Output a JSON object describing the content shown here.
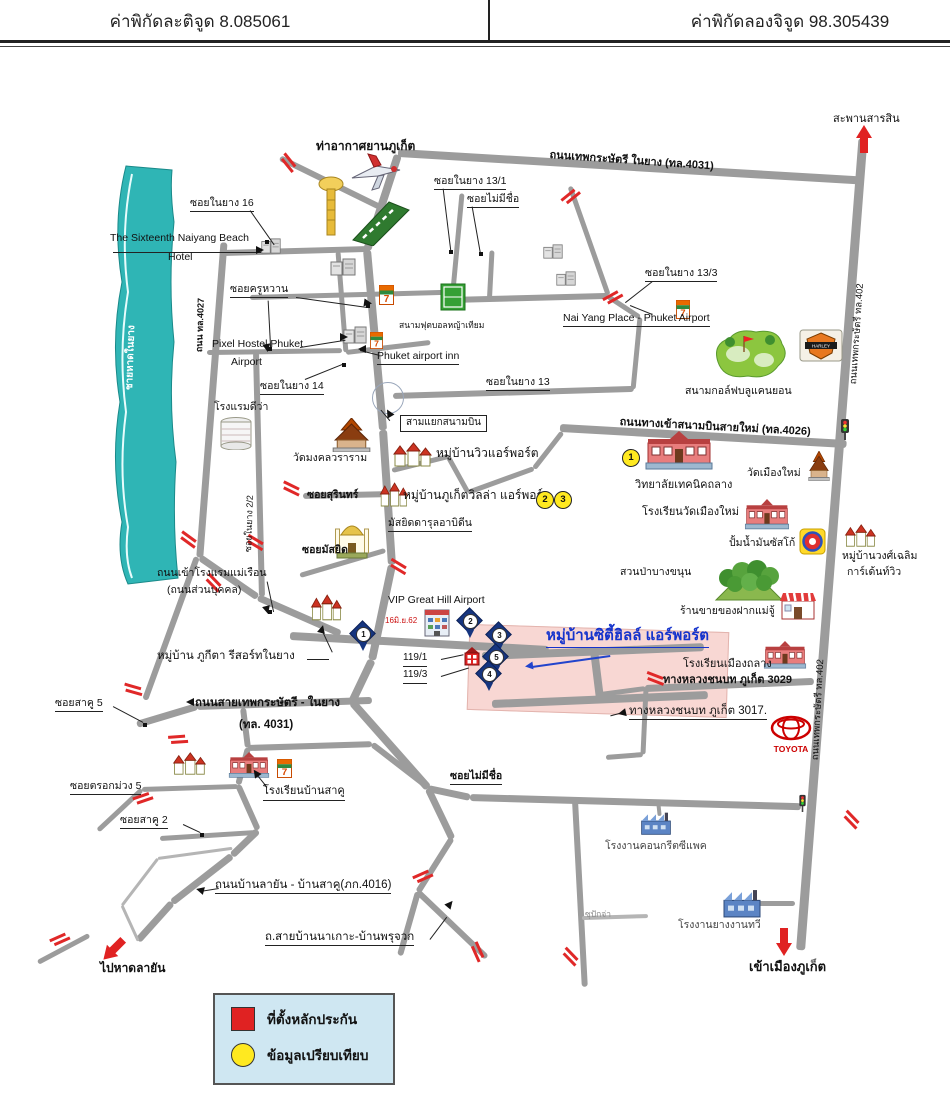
{
  "header": {
    "latitude": "ค่าพิกัดละติจูด 8.085061",
    "longitude": "ค่าพิกัดลองจิจูด 98.305439"
  },
  "destination": {
    "name": "หมู่บ้านซิตี้ฮิลล์ แอร์พอร์ต",
    "house_numbers": [
      "119/1",
      "119/3"
    ],
    "latitude": "8.085061",
    "longitude": "98.305439"
  },
  "legend": {
    "collateral_label": "ที่ตั้งหลักประกัน",
    "comparison_label": "ข้อมูลเปรียบเทียบ",
    "collateral_color": "#e02222",
    "comparison_color": "#ffe920",
    "box_bg": "#cfe7f2"
  },
  "map": {
    "labels": [
      {
        "name": "airport-name",
        "text": "ท่าอากาศยานภูเก็ต",
        "x": 316,
        "y": 139,
        "cls": "b f12"
      },
      {
        "name": "sarasin-bridge",
        "text": "สะพานสารสิน",
        "x": 833,
        "y": 113,
        "cls": "f11"
      },
      {
        "name": "soi-naiyang-16",
        "text": "ซอยในยาง 16",
        "x": 190,
        "y": 197,
        "cls": "u"
      },
      {
        "name": "sixteenth-hotel-1",
        "text": "The Sixteenth Naiyang Beach",
        "x": 110,
        "y": 232,
        "cls": ""
      },
      {
        "name": "sixteenth-hotel-2",
        "text": "Hotel",
        "x": 168,
        "y": 251,
        "cls": ""
      },
      {
        "name": "road-thep-naiyang-4031",
        "text": "ถนนเทพกระษัตรี ในยาง (ทล.4031)",
        "x": 550,
        "y": 149,
        "cls": "b f11",
        "r": 4
      },
      {
        "name": "soi-naiyang-13-1",
        "text": "ซอยในยาง 13/1",
        "x": 434,
        "y": 175,
        "cls": "u"
      },
      {
        "name": "soi-no-name-north",
        "text": "ซอยไม่มีชื่อ",
        "x": 467,
        "y": 193,
        "cls": "u"
      },
      {
        "name": "soi-naiyang-13-3",
        "text": "ซอยในยาง 13/3",
        "x": 645,
        "y": 267,
        "cls": "u"
      },
      {
        "name": "naiyang-place",
        "text": "Nai Yang Place - Phuket Airport",
        "x": 563,
        "y": 312,
        "cls": "u"
      },
      {
        "name": "road-402-upper",
        "text": "ถนนเทพกระษัตรี ทล.402",
        "x": 848,
        "y": 384,
        "cls": "f95",
        "r": -86
      },
      {
        "name": "football-field",
        "text": "สนามฟุตบอลหญ้าเทียม",
        "x": 399,
        "y": 320,
        "cls": "f85"
      },
      {
        "name": "soi-kru-waan",
        "text": "ซอยครูหวาน",
        "x": 230,
        "y": 283,
        "cls": "u"
      },
      {
        "name": "road-4027",
        "text": "ถนน ทล.4027",
        "x": 194,
        "y": 352,
        "cls": "f9 b",
        "r": -88
      },
      {
        "name": "pixel-hostel-1",
        "text": "Pixel Hostel Phuket",
        "x": 212,
        "y": 338,
        "cls": ""
      },
      {
        "name": "pixel-hostel-2",
        "text": "Airport",
        "x": 231,
        "y": 356,
        "cls": ""
      },
      {
        "name": "phuket-airport-inn",
        "text": "Phuket airport inn",
        "x": 377,
        "y": 350,
        "cls": "u"
      },
      {
        "name": "soi-naiyang-14",
        "text": "ซอยในยาง 14",
        "x": 260,
        "y": 380,
        "cls": "u"
      },
      {
        "name": "soi-naiyang-13",
        "text": "ซอยในยาง 13",
        "x": 486,
        "y": 376,
        "cls": "u"
      },
      {
        "name": "airport-junction",
        "text": "สามแยกสนามบิน",
        "x": 400,
        "y": 415,
        "cls": "box f10"
      },
      {
        "name": "dewa-hotel",
        "text": "โรงแรมดีว่า",
        "x": 214,
        "y": 401,
        "cls": ""
      },
      {
        "name": "wat-mongkhol-wararam",
        "text": "วัดมงคลวราราม",
        "x": 293,
        "y": 452,
        "cls": ""
      },
      {
        "name": "soi-naiyang-2-2",
        "text": "ซอยในยาง 2/2",
        "x": 243,
        "y": 552,
        "cls": "f9",
        "r": -88
      },
      {
        "name": "soi-surin",
        "text": "ซอยสุรินทร์",
        "x": 307,
        "y": 489,
        "cls": "b"
      },
      {
        "name": "muban-view-airport",
        "text": "หมู่บ้านวิวแอร์พอร์ต",
        "x": 436,
        "y": 446,
        "cls": "f12"
      },
      {
        "name": "muban-phuket-villa-airport",
        "text": "หมู่บ้านภูเก็ตวิลล่า แอร์พอร์ต",
        "x": 403,
        "y": 488,
        "cls": "f12"
      },
      {
        "name": "masjid-darul-abidin",
        "text": "มัสยิดดารุลอาบิดีน",
        "x": 388,
        "y": 517,
        "cls": "u"
      },
      {
        "name": "soi-masjid",
        "text": "ซอยมัสยิด",
        "x": 302,
        "y": 544,
        "cls": "b"
      },
      {
        "name": "road-4026",
        "text": "ถนนทางเข้าสนามบินสายใหม่ (ทล.4026)",
        "x": 620,
        "y": 416,
        "cls": "b f11",
        "r": 3
      },
      {
        "name": "thalang-technical-college",
        "text": "วิทยาลัยเทคนิคถลาง",
        "x": 635,
        "y": 479,
        "cls": "f11"
      },
      {
        "name": "wat-muang-mai",
        "text": "วัดเมืองใหม่",
        "x": 747,
        "y": 467,
        "cls": ""
      },
      {
        "name": "school-wat-muang-mai",
        "text": "โรงเรียนวัดเมืองใหม่",
        "x": 642,
        "y": 506,
        "cls": "f11"
      },
      {
        "name": "susco-gas-station",
        "text": "ปั้มน้ำมันซัสโก้",
        "x": 729,
        "y": 537,
        "cls": ""
      },
      {
        "name": "muban-wong-chaloem-1",
        "text": "หมู่บ้านวงศ์เฉลิม",
        "x": 842,
        "y": 550,
        "cls": ""
      },
      {
        "name": "muban-wong-chaloem-2",
        "text": "การ์เด้นท์วิว",
        "x": 847,
        "y": 566,
        "cls": ""
      },
      {
        "name": "bang-khanun-forest-park",
        "text": "สวนป่าบางขนุน",
        "x": 620,
        "y": 566,
        "cls": ""
      },
      {
        "name": "mae-ju-souvenir-shop",
        "text": "ร้านขายของฝากแม่จู้",
        "x": 680,
        "y": 605,
        "cls": ""
      },
      {
        "name": "mae-ruen-road-1",
        "text": "ถนนเข้าโรงแรมแม่เรือน",
        "x": 157,
        "y": 567,
        "cls": ""
      },
      {
        "name": "mae-ruen-road-2",
        "text": "(ถนนส่วนบุคคล)",
        "x": 167,
        "y": 584,
        "cls": ""
      },
      {
        "name": "vip-great-hill-airport",
        "text": "VIP Great Hill Airport",
        "x": 388,
        "y": 594,
        "cls": ""
      },
      {
        "name": "red-date-note",
        "text": "16มิ.ย.62",
        "x": 385,
        "y": 616,
        "cls": "red f8"
      },
      {
        "name": "muban-city-hill-airport",
        "text": "หมู่บ้านซิตี้ฮิลล์ แอร์พอร์ต",
        "x": 546,
        "y": 627,
        "cls": "blue b u f15"
      },
      {
        "name": "house-no-119-1",
        "text": "119/1",
        "x": 403,
        "y": 652,
        "cls": "u f10"
      },
      {
        "name": "house-no-119-3",
        "text": "119/3",
        "x": 403,
        "y": 669,
        "cls": "u f10"
      },
      {
        "name": "muban-phukita-resort",
        "text": "หมู่บ้าน ภูกีตา รีสอร์ทในยาง",
        "x": 157,
        "y": 649,
        "cls": "f115"
      },
      {
        "name": "school-muang-thalang",
        "text": "โรงเรียนเมืองถลาง",
        "x": 683,
        "y": 658,
        "cls": "f11"
      },
      {
        "name": "road-3029",
        "text": "ทางหลวงชนบท ภูเก็ต 3029",
        "x": 663,
        "y": 674,
        "cls": "b f11"
      },
      {
        "name": "road-3017",
        "text": "ทางหลวงชนบท ภูเก็ต 3017.",
        "x": 629,
        "y": 704,
        "cls": "u f115"
      },
      {
        "name": "road-402-lower",
        "text": "ถนนเทพกระษัตรี ทล.402",
        "x": 810,
        "y": 760,
        "cls": "f95",
        "r": -87
      },
      {
        "name": "soi-saku-5",
        "text": "ซอยสาคู 5",
        "x": 55,
        "y": 697,
        "cls": "u"
      },
      {
        "name": "road-4031-west-1",
        "text": "ถนนสายเทพกระษัตรี - ในยาง",
        "x": 195,
        "y": 696,
        "cls": "b f115"
      },
      {
        "name": "road-4031-west-2",
        "text": "(ทล. 4031)",
        "x": 239,
        "y": 718,
        "cls": "b f115"
      },
      {
        "name": "soi-trok-muang-5",
        "text": "ซอยตรอกม่วง 5",
        "x": 70,
        "y": 780,
        "cls": "u"
      },
      {
        "name": "soi-saku-2",
        "text": "ซอยสาคู 2",
        "x": 120,
        "y": 814,
        "cls": "u"
      },
      {
        "name": "school-ban-saku",
        "text": "โรงเรียนบ้านสาคู",
        "x": 263,
        "y": 785,
        "cls": "u f11"
      },
      {
        "name": "soi-no-name-south",
        "text": "ซอยไม่มีชื่อ",
        "x": 450,
        "y": 770,
        "cls": "b u"
      },
      {
        "name": "road-ban-layan-saku-4016",
        "text": "ถนนบ้านลายัน - บ้านสาคู(ภก.4016)",
        "x": 215,
        "y": 878,
        "cls": "u f115"
      },
      {
        "name": "road-ban-na-ko",
        "text": "ถ.สายบ้านนาเกาะ-บ้านพรุจวก",
        "x": 265,
        "y": 930,
        "cls": "u f115"
      },
      {
        "name": "to-layan-beach",
        "text": "ไปหาดลายัน",
        "x": 100,
        "y": 961,
        "cls": "b f12"
      },
      {
        "name": "su-pak-ja",
        "text": "ซุปักจ่า",
        "x": 585,
        "y": 909,
        "cls": "gray f85"
      },
      {
        "name": "cpac-concrete-factory",
        "text": "โรงงานคอนกรีตซีแพค",
        "x": 605,
        "y": 840,
        "cls": "dim"
      },
      {
        "name": "ngan-thawee-rubber-factory",
        "text": "โรงงานยางงานทวี",
        "x": 678,
        "y": 919,
        "cls": "dim"
      },
      {
        "name": "to-phuket-town",
        "text": "เข้าเมืองภูเก็ต",
        "x": 749,
        "y": 959,
        "cls": "b f13"
      },
      {
        "name": "blue-canyon-golf",
        "text": "สนามกอล์ฟบลูแคนยอน",
        "x": 685,
        "y": 385,
        "cls": ""
      },
      {
        "name": "naiyang-beach",
        "text": "ชายหาดในยาง",
        "x": 124,
        "y": 390,
        "cls": "white b f10",
        "r": -88
      }
    ],
    "site_pins": [
      {
        "num": "1",
        "x": 363,
        "y": 634
      },
      {
        "num": "2",
        "x": 470,
        "y": 621
      },
      {
        "num": "3",
        "x": 499,
        "y": 635
      },
      {
        "num": "5",
        "x": 496,
        "y": 657
      },
      {
        "num": "4",
        "x": 489,
        "y": 674
      }
    ],
    "comparison_markers": [
      {
        "num": "1",
        "x": 622,
        "y": 449
      },
      {
        "num": "2",
        "x": 536,
        "y": 491
      },
      {
        "num": "3",
        "x": 554,
        "y": 491
      }
    ],
    "colors": {
      "road": "#9c9c9c",
      "beach": "#2fb5b5",
      "destination_text": "#1533cc",
      "collateral_marker": "#e02222",
      "comparison_marker": "#ffe920",
      "railway_crossing": "#e02828"
    }
  }
}
